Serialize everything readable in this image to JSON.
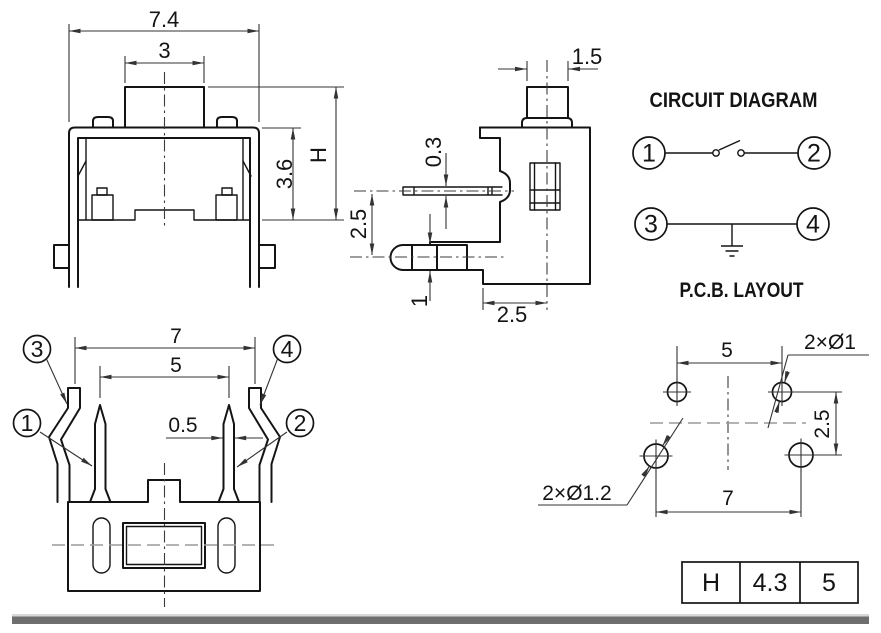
{
  "colors": {
    "line": "#141414",
    "dimension_line": "#333333",
    "centerline_gray": "#9a9a9a",
    "footer_bar": "#6e6e6e",
    "background": "#ffffff"
  },
  "front_view": {
    "dim_total_width": "7.4",
    "dim_button_width": "3",
    "dim_body_height": "3.6",
    "dim_total_height": "H"
  },
  "side_view": {
    "dim_button_width": "1.5",
    "dim_pin_thickness": "0.3",
    "dim_pin_spacing": "2.5",
    "dim_lower_pin_thickness": "1",
    "dim_bottom_offset": "2.5"
  },
  "circuit": {
    "title": "CIRCUIT DIAGRAM",
    "terminals": [
      "1",
      "2",
      "3",
      "4"
    ]
  },
  "pcb": {
    "title": "P.C.B. LAYOUT",
    "dim_top_pitch": "5",
    "dim_bottom_pitch": "7",
    "dim_row_pitch": "2.5",
    "label_small_holes": "2×Ø1",
    "label_large_holes": "2×Ø1.2"
  },
  "bottom_view": {
    "dim_outer_pitch": "7",
    "dim_inner_pitch": "5",
    "dim_pin_width": "0.5",
    "terminals": [
      "1",
      "2",
      "3",
      "4"
    ]
  },
  "table": {
    "cells": [
      "H",
      "4.3",
      "5"
    ]
  }
}
